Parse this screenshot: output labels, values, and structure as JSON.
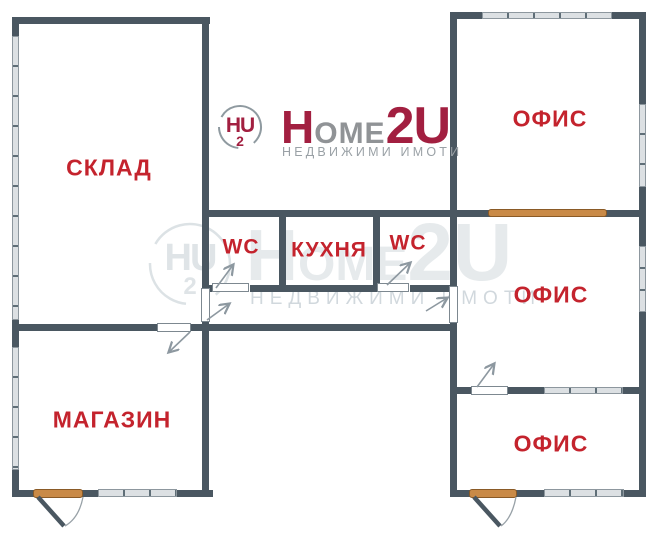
{
  "brand": {
    "icon_letters": "HU",
    "icon_sub": "2",
    "wordmark_h": "H",
    "wordmark_ome": "OME",
    "wordmark_2u": "2U",
    "tagline": "НЕДВИЖИМИ ИМОТИ"
  },
  "watermark": {
    "icon_letters": "HU",
    "icon_sub": "2",
    "wordmark_h": "H",
    "wordmark_ome": "ОМЕ",
    "wordmark_2u": "2U",
    "tagline": "НЕДВИЖИМИ ИМОТИ"
  },
  "rooms": {
    "sklad": "СКЛАД",
    "magazin": "МАГАЗИН",
    "wc_left": "WC",
    "kitchen": "КУХНЯ",
    "wc_right": "WC",
    "office_top": "ОФИС",
    "office_middle": "ОФИС",
    "office_bottom": "ОФИС"
  },
  "colors": {
    "wall": "#4a5761",
    "room_label": "#c4232d",
    "logo_crimson": "#a21f40",
    "logo_gray": "#909396",
    "accent_orange": "#c98a47",
    "window_fill": "#dce0e3"
  }
}
